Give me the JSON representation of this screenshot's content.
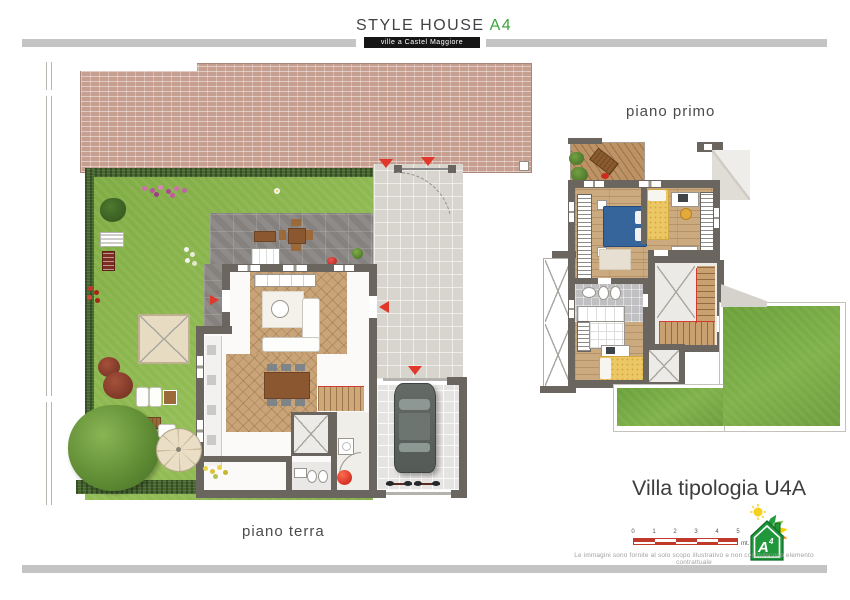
{
  "header": {
    "brand": "STYLE HOUSE",
    "brand_suffix": "A4",
    "subtitle": "ville a Castel Maggiore"
  },
  "floor_labels": {
    "ground": "piano terra",
    "first": "piano primo"
  },
  "footer": {
    "title": "Villa tipologia U4A",
    "scale": {
      "ticks": [
        "0",
        "1",
        "2",
        "3",
        "4",
        "5"
      ],
      "unit": "mt."
    },
    "energy": {
      "letter": "A",
      "sup": "4"
    },
    "disclaimer": "Le immagini sono fornite al solo scopo illustrativo e non costituiscono elemento contrattuale"
  },
  "icons": {
    "entrance_arrow": "red triangle direction marker",
    "energy_sun": "yellow sun",
    "energy_house": "green house energy-class badge with arrows fan"
  },
  "colors": {
    "accent_green": "#3ba43a",
    "subtitle_bar": "#161616",
    "divider_gray": "#c4c4c4",
    "arrow_red": "#e2372b",
    "wall_gray": "#6b655f",
    "lawn_green": "#87b14b",
    "roof_brick": "#c79f91",
    "scale_red": "#c0392b",
    "bed_blue": "#36659c",
    "bed_yellow": "#ecc765"
  }
}
